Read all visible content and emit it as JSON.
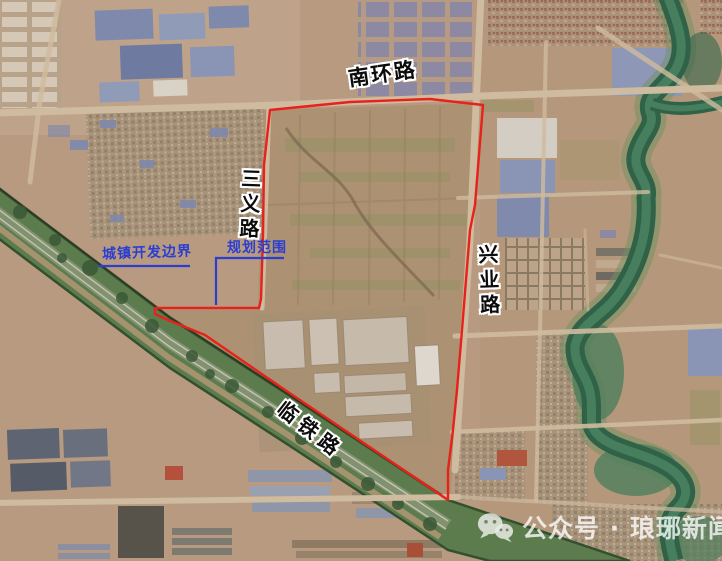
{
  "map": {
    "type": "satellite-planning-map",
    "road_labels": {
      "south_ring_road": "南环路",
      "sanyi_road": "三义路",
      "xingye_road": "兴业路",
      "lintie_road": "临铁路"
    },
    "boundary_labels": {
      "urban_development_boundary": "城镇开发边界",
      "planning_scope": "规划范围"
    },
    "legend": {
      "planning_boundary_color": "#e8211a",
      "annotation_color": "#2b3ed2"
    },
    "colors": {
      "terrain_tan": "#b79a7f",
      "railway_corridor_green": "#5d7c4e",
      "river_green": "#2f6247",
      "factory_roof_blue": "#8a94b5"
    }
  },
  "watermark": {
    "icon": "wechat-icon",
    "text": "公众号 · 琅琊新闻网"
  }
}
